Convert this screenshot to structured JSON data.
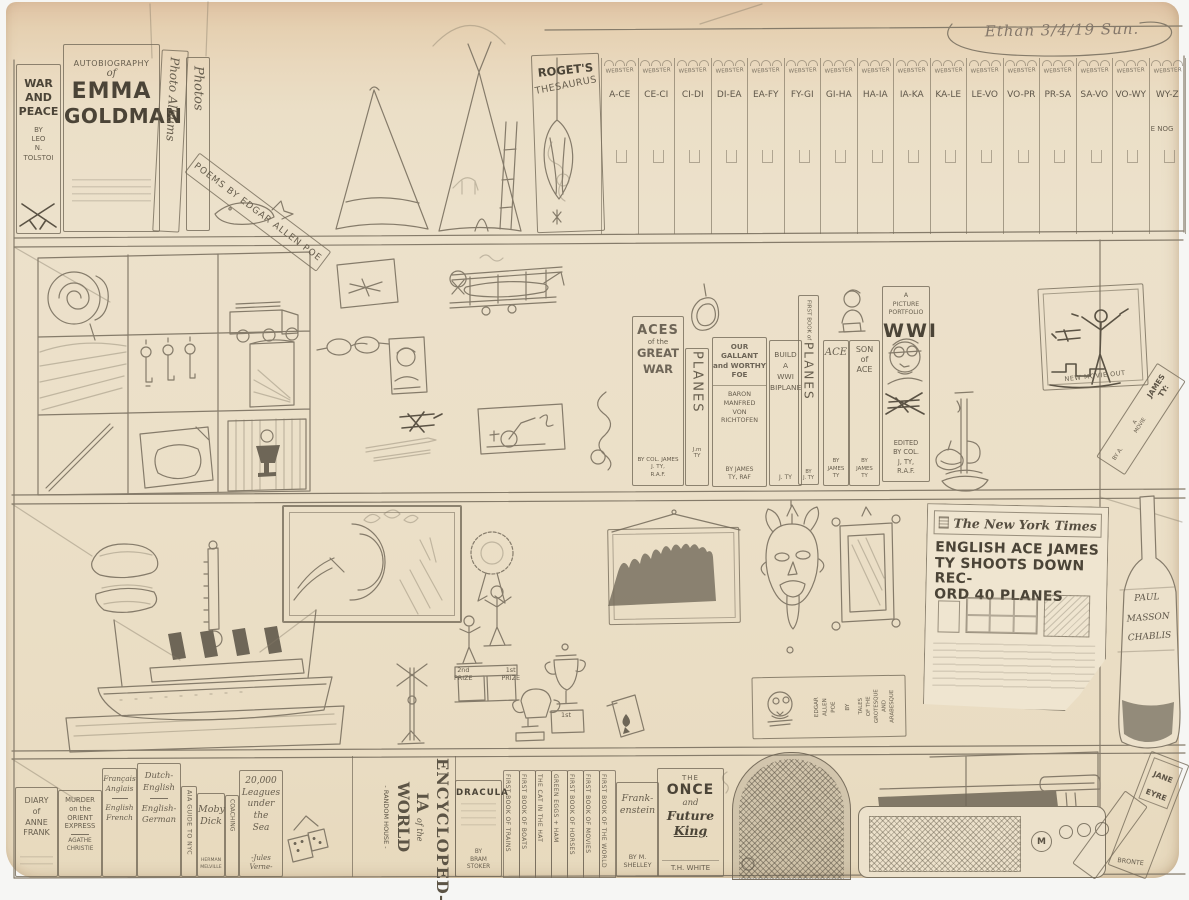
{
  "scan": {
    "signature": "Ethan  3/4/19  Sun."
  },
  "shelf1": {
    "war_and_peace": {
      "title": "WAR\nAND\nPEACE",
      "by": "BY\nLEO\nN.\nTOLSTOI"
    },
    "emma_goldman": {
      "line1": "AUTOBIOGRAPHY",
      "line2": "of",
      "line3": "EMMA",
      "line4": "GOLDMAN"
    },
    "photo_album": {
      "title": "Photo Albums"
    },
    "photos": {
      "title": "Photos"
    },
    "poe_poems": {
      "title": "POEMS BY EDGAR ALLEN POE"
    },
    "rogets": {
      "line1": "ROGET'S",
      "line2": "THESAURUS"
    },
    "webster": {
      "label": "WEBSTER",
      "volumes": [
        "A-CE",
        "CE-CI",
        "CI-DI",
        "DI-EA",
        "EA-FY",
        "FY-GI",
        "GI-HA",
        "HA-IA",
        "IA-KA",
        "KA-LE",
        "LE-VO",
        "VO-PR",
        "PR-SA",
        "SA-VO",
        "VO-WY",
        "WY-Z"
      ],
      "last_note": "E NOG"
    }
  },
  "shelf2": {
    "aces_great_war": {
      "line1": "ACES",
      "line2": "of the",
      "line3": "GREAT",
      "line4": "WAR",
      "author": "BY COL. JAMES\nJ. TY,\nR.A.F."
    },
    "planes": {
      "title": "PLANES",
      "author": "J.m\nTY"
    },
    "gallant_foe": {
      "title": "OUR\nGALLANT\nand WORTHY\nFOE",
      "subject": "BARON\nMANFRED\nVON\nRICHTOFEN",
      "author": "BY JAMES\nTY, RAF"
    },
    "build_biplane": {
      "title": "BUILD\nA\nWWI\nBIPLANE",
      "author": "J. TY"
    },
    "first_book_planes": {
      "pre": "FIRST BOOK of",
      "title": "PLANES",
      "author": "BY\nJ. TY"
    },
    "ace": {
      "title": "ACE",
      "author": "BY\nJAMES\nTY"
    },
    "son_of_ace": {
      "title": "SON\nof\nACE",
      "author": "BY\nJAMES\nTY"
    },
    "wwi_portfolio": {
      "pre": "A\nPICTURE\nPORTFOLIO",
      "title": "WWI",
      "post": "EDITED\nBY COL.\nJ, TY,\nR.A.F."
    },
    "movie_poster": {
      "caption": "NEW MOVIE OUT"
    },
    "james_ty_book": {
      "author": "BY A.",
      "mid": "A\nMOVIE",
      "title": "JAMES\nTY:"
    }
  },
  "shelf3": {
    "newspaper": {
      "masthead": "The New York Times",
      "headline": "ENGLISH ACE JAMES\nTY SHOOTS DOWN REC-\nORD 40 PLANES"
    },
    "wine_bottle": {
      "label": "PAUL\nMASSON\nCHABLIS"
    },
    "trophies": {
      "second": "2nd\nPRIZE",
      "first": "1st\nPRIZE",
      "first_small": "1st"
    },
    "poe_tales": {
      "author": "EDGAR\nALLEN\nPOE",
      "by": "BY",
      "title": "TALES\nOF THE\nGROTESQUE\nAND\nARABESQUE"
    }
  },
  "shelf4": {
    "anne_frank": {
      "title": "DIARY\nof\nANNE\nFRANK"
    },
    "orient_express": {
      "title": "MURDER\non the\nORIENT\nEXPRESS",
      "author": "AGATHE\nCHRISTIE"
    },
    "french_english": {
      "top": "Français\nAnglais",
      "bottom": "English\nFrench"
    },
    "dutch_german": {
      "top": "Dutch-\nEnglish",
      "bottom": "English-\nGerman"
    },
    "aia_guide": {
      "title": "AIA GUIDE TO NYC"
    },
    "moby_dick": {
      "title": "Moby\nDick",
      "author": "HERMAN\nMELVILLE"
    },
    "coaching": {
      "title": "COACHING"
    },
    "leagues": {
      "title": "20,000\nLeagues\nunder\nthe\nSea",
      "author": "-Jules\nVerne-"
    },
    "encyclopedia": {
      "line1": "ENCYCLOPED-",
      "line2a": "IA",
      "line2b": "of the",
      "line2c": "WORLD",
      "line3": "- RANDOM HOUSE -"
    },
    "dracula": {
      "title": "DRACULA",
      "author": "BY\nBRAM\nSTOKER"
    },
    "thin_books": [
      "FIRST BOOK OF TRAINS",
      "FIRST BOOK OF BOATS",
      "THE CAT IN THE HAT",
      "GREEN EGGS + HAM",
      "FIRST BOOK OF HORSES",
      "FIRST BOOK OF MOVIES",
      "FIRST BOOK OF THE WORLD"
    ],
    "frankenstein": {
      "title": "Frank-\nenstein",
      "author": "BY M.\nSHELLEY"
    },
    "once_future_king": {
      "line1": "THE",
      "line2": "ONCE",
      "line3": "and",
      "line4": "Future",
      "line5": "King",
      "author": "T.H. WHITE"
    },
    "radio": {
      "logo": "M"
    },
    "jane_eyre": {
      "title": "JANE\nEYRE",
      "author": "BRONTE"
    }
  }
}
